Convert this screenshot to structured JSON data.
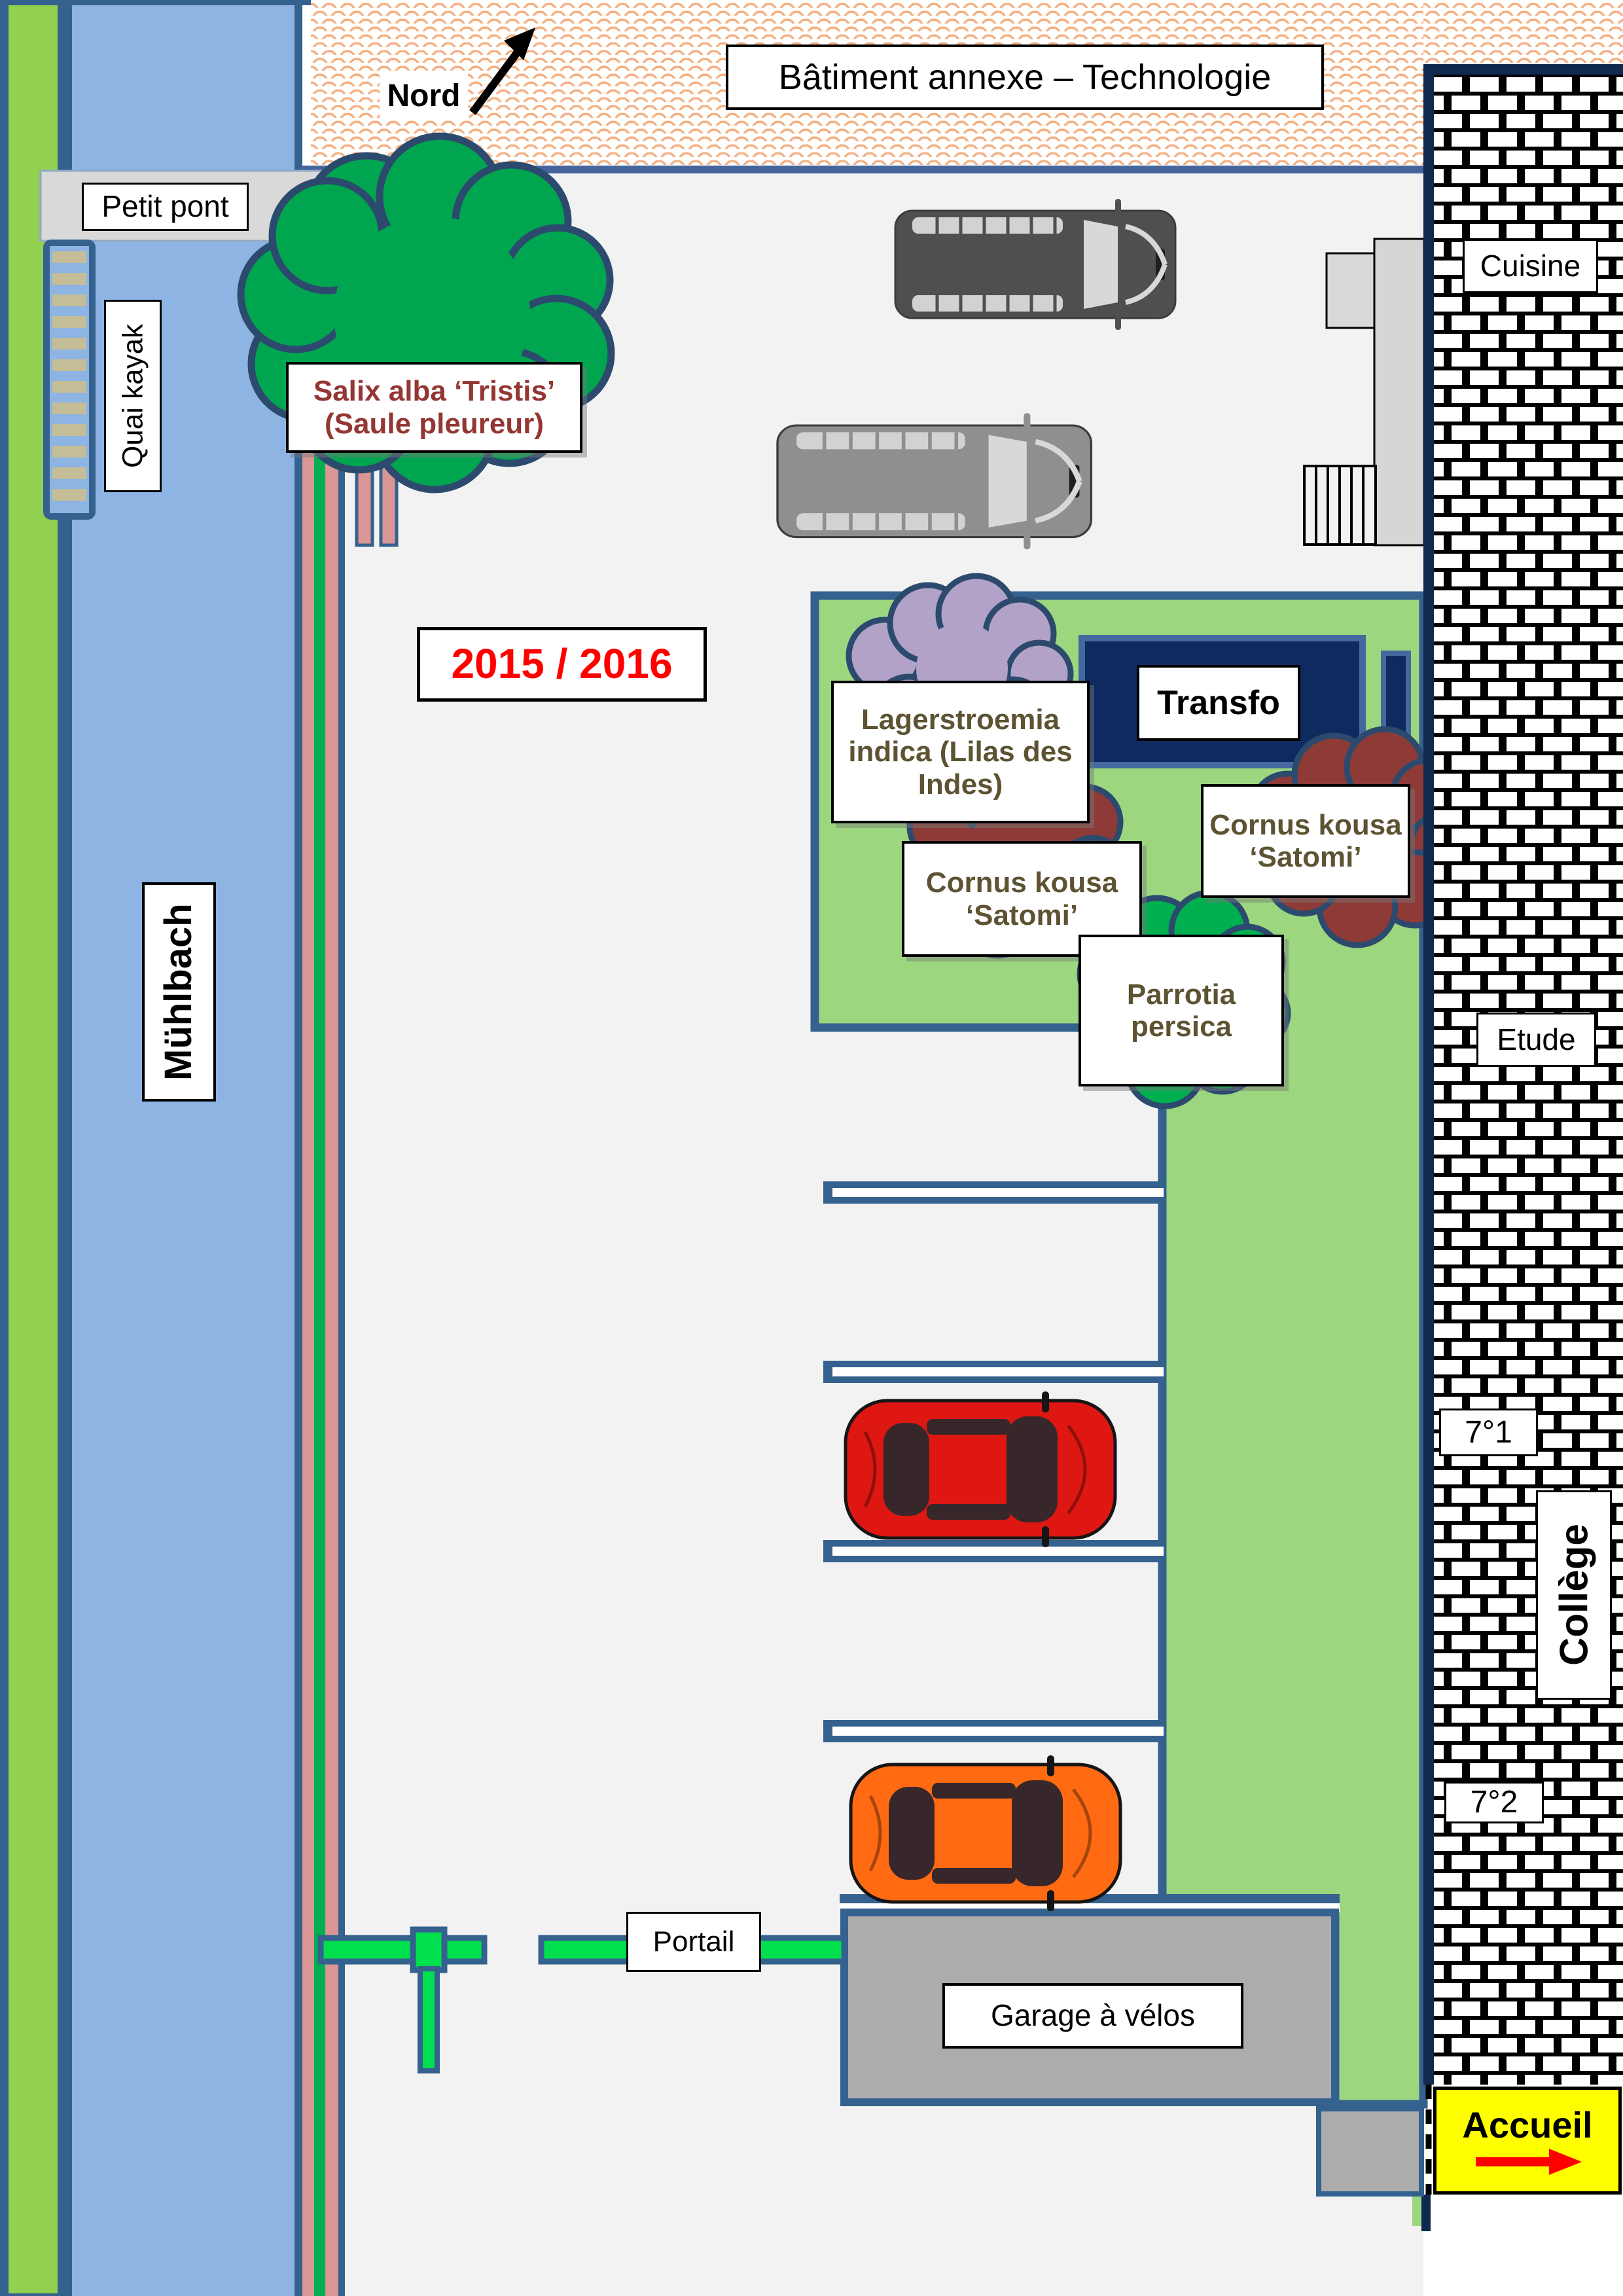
{
  "labels": {
    "north": "Nord",
    "annex_building": "Bâtiment annexe – Technologie",
    "small_bridge": "Petit pont",
    "kayak_dock": "Quai kayak",
    "river_name": "Mühlbach",
    "school_year": "2015 / 2016",
    "willow_line1": "Salix alba ‘Tristis’",
    "willow_line2": "(Saule pleureur)",
    "lagerstroemia": "Lagerstroemia indica (Lilas des Indes)",
    "cornus_left": "Cornus kousa ‘Satomi’",
    "cornus_right": "Cornus kousa ‘Satomi’",
    "parrotia": "Parrotia persica",
    "transfo": "Transfo",
    "cuisine": "Cuisine",
    "etude": "Etude",
    "room_7_1": "7°1",
    "room_7_2": "7°2",
    "college": "Collège",
    "accueil": "Accueil",
    "gate": "Portail",
    "bike_garage": "Garage à vélos"
  },
  "colors": {
    "river": "#8DB4E2",
    "bank_green": "#92D050",
    "lawn_green": "#9CD77F",
    "hedge_pink": "#D99694",
    "hedge_stripe_green": "#00B050",
    "tree_green": "#00A64F",
    "shrub_lilac": "#B3A2C7",
    "shrub_maroon": "#8E3B38",
    "shrub_green": "#00B050",
    "border_blue": "#35618F",
    "wall_navy": "#10294F",
    "transfo_navy": "#0E2A5F",
    "courtyard_gray": "#F2F2F2",
    "bridge_gray": "#D9D9D9",
    "garage_gray": "#ACACAC",
    "ladder_tan": "#C5BD98",
    "hatch_orange": "#F4B183",
    "gate_green": "#00DF4E",
    "accueil_yellow": "#FFFF00",
    "arrow_red": "#FF0000",
    "year_red": "#FF0000",
    "willow_text_red": "#943634",
    "plant_text_olive": "#5D5333",
    "van_dark": "#4F4F4F",
    "van_light": "#8F8F8F",
    "car_red": "#DE1713",
    "car_orange": "#FF6A13"
  }
}
